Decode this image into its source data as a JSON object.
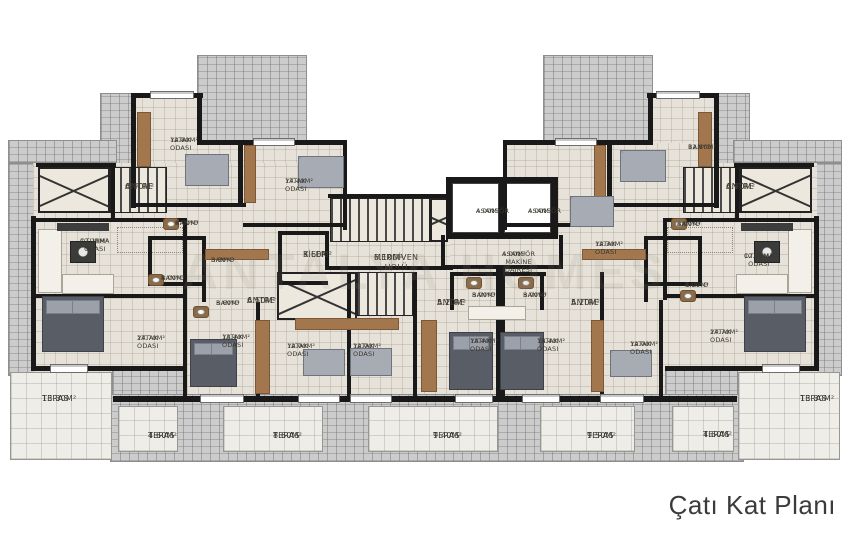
{
  "title": "Çatı Kat Planı",
  "watermark": "ANTALYA HOMES",
  "colors": {
    "wall": "#191919",
    "roof_tile": "#cccccc",
    "floor": "#e6e2d9",
    "terrace": "#efede8",
    "wood": "#a3774e",
    "bed_dark": "#595d66",
    "bed_light": "#a7abb3",
    "label_text": "#3a382f",
    "title_text": "#3b3b3b"
  },
  "plan": {
    "rooms": [
      {
        "name": "YATAK ODASI",
        "area": "12.80m²",
        "x": 170,
        "y": 136,
        "s": "sm"
      },
      {
        "name": "YATAK ODASI",
        "area": "17.40m²",
        "x": 285,
        "y": 177,
        "s": "sm"
      },
      {
        "name": "ANTRE",
        "area": "6.90m²",
        "x": 125,
        "y": 182,
        "s": "md"
      },
      {
        "name": "BANYO",
        "area": "4.00m²",
        "x": 175,
        "y": 219,
        "s": "sm"
      },
      {
        "name": "OTURMA ODASI",
        "area": "12.20m²",
        "x": 80,
        "y": 237,
        "s": "sm",
        "w": 70
      },
      {
        "name": "BANYO",
        "area": "3.30m²",
        "x": 211,
        "y": 256,
        "s": "sm"
      },
      {
        "name": "BANYO",
        "area": "4.00m²",
        "x": 161,
        "y": 274,
        "s": "sm"
      },
      {
        "name": "BANYO",
        "area": "3.60m²",
        "x": 216,
        "y": 299,
        "s": "sm"
      },
      {
        "name": "ANTRE",
        "area": "6.50m²",
        "x": 247,
        "y": 296,
        "s": "md"
      },
      {
        "name": "YATAK ODASI",
        "area": "27.70m²",
        "x": 137,
        "y": 334,
        "s": "sm"
      },
      {
        "name": "YATAK ODASI",
        "area": "13.40m²",
        "x": 222,
        "y": 333,
        "s": "sm"
      },
      {
        "name": "YATAK ODASI",
        "area": "12.00m²",
        "x": 287,
        "y": 342,
        "s": "sm"
      },
      {
        "name": "YATAK ODASI",
        "area": "12.00m²",
        "x": 353,
        "y": 342,
        "s": "sm"
      },
      {
        "name": "TERAS",
        "area": "13.30m²",
        "x": 42,
        "y": 394,
        "s": "md"
      },
      {
        "name": "KİLER",
        "area": "3.60m²",
        "x": 303,
        "y": 250,
        "s": "md"
      },
      {
        "name": "MERDİVEN HOLÜ",
        "area": "6.10m²",
        "x": 374,
        "y": 253,
        "s": "md"
      },
      {
        "name": "ASANSÖR",
        "area": "4.00m²",
        "x": 476,
        "y": 207,
        "s": "sm"
      },
      {
        "name": "ASANSÖR",
        "area": "4.00m²",
        "x": 528,
        "y": 207,
        "s": "sm"
      },
      {
        "name": "ASANSÖR MAKİNE DAİRESİ",
        "area": "4.00m²",
        "x": 502,
        "y": 250,
        "s": "sm",
        "w": 130
      },
      {
        "name": "ANTRE",
        "area": "5.20m²",
        "x": 437,
        "y": 298,
        "s": "md"
      },
      {
        "name": "BANYO",
        "area": "3.90m²",
        "x": 472,
        "y": 291,
        "s": "sm"
      },
      {
        "name": "BANYO",
        "area": "3.90m²",
        "x": 523,
        "y": 291,
        "s": "sm"
      },
      {
        "name": "ANTRE",
        "area": "5.20m²",
        "x": 571,
        "y": 298,
        "s": "md"
      },
      {
        "name": "YATAK ODASI",
        "area": "13.40m²",
        "x": 470,
        "y": 337,
        "s": "sm"
      },
      {
        "name": "YATAK ODASI",
        "area": "13.40m²",
        "x": 537,
        "y": 337,
        "s": "sm"
      },
      {
        "name": "YATAK ODASI",
        "area": "12.30m²",
        "x": 595,
        "y": 240,
        "s": "sm"
      },
      {
        "name": "YATAK ODASI",
        "area": "12.00m²",
        "x": 630,
        "y": 340,
        "s": "sm"
      },
      {
        "name": "BANYO",
        "area": "12.80m²",
        "x": 688,
        "y": 143,
        "s": "sm"
      },
      {
        "name": "ANTRE",
        "area": "6.90m²",
        "x": 726,
        "y": 182,
        "s": "md"
      },
      {
        "name": "BANYO",
        "area": "4.00m²",
        "x": 677,
        "y": 220,
        "s": "sm"
      },
      {
        "name": "OTURMA ODASI",
        "area": "12.20m²",
        "x": 744,
        "y": 252,
        "s": "sm",
        "w": 36
      },
      {
        "name": "BANYO",
        "area": "4.20m²",
        "x": 685,
        "y": 281,
        "s": "sm"
      },
      {
        "name": "YATAK ODASI",
        "area": "27.70m²",
        "x": 710,
        "y": 328,
        "s": "sm"
      },
      {
        "name": "TERAS",
        "area": "13.30m²",
        "x": 800,
        "y": 394,
        "s": "md"
      },
      {
        "name": "TERAS",
        "area": "4.60m²",
        "x": 148,
        "y": 431,
        "s": "md"
      },
      {
        "name": "TERAS",
        "area": "8.60m²",
        "x": 273,
        "y": 431,
        "s": "md"
      },
      {
        "name": "TERAS",
        "area": "9.40m²",
        "x": 433,
        "y": 431,
        "s": "md"
      },
      {
        "name": "TERAS",
        "area": "9.50m²",
        "x": 587,
        "y": 431,
        "s": "md"
      },
      {
        "name": "TERAS",
        "area": "4.60m²",
        "x": 703,
        "y": 430,
        "s": "md"
      }
    ]
  }
}
